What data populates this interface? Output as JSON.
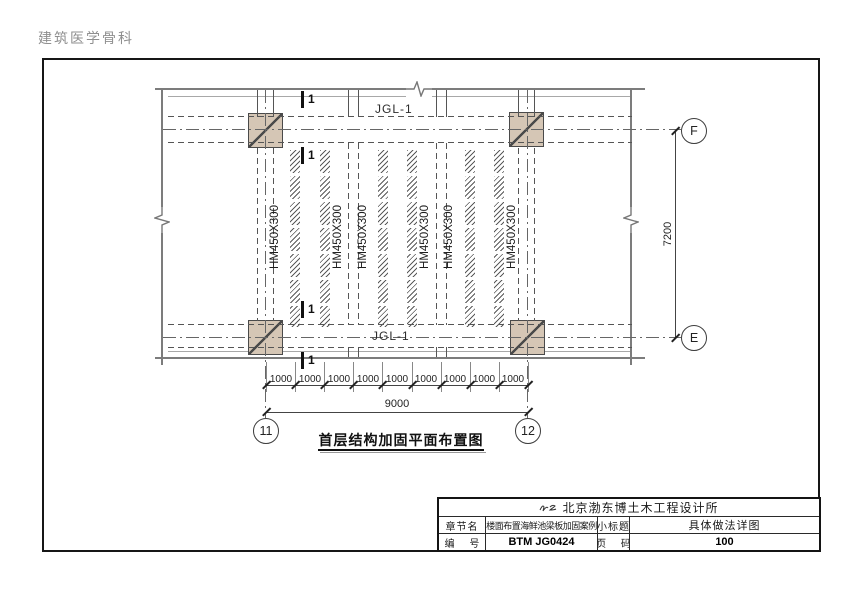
{
  "watermark": "建筑医学骨科",
  "plan": {
    "top_beam_label": "JGL-1",
    "bottom_beam_label": "JGL-1",
    "beam_labels": [
      "HM450X300",
      "HM450X300",
      "HM450X300",
      "HM450X300",
      "HM450X300",
      "HM450X300"
    ],
    "section_marks": [
      "1",
      "1",
      "1",
      "1"
    ],
    "grid_bubbles": {
      "right_top": "F",
      "right_bottom": "E",
      "bottom_left": "11",
      "bottom_right": "12"
    }
  },
  "dimensions": {
    "vertical_total": "7200",
    "segments": [
      "1000",
      "1000",
      "1000",
      "1000",
      "1000",
      "1000",
      "1000",
      "1000",
      "1000"
    ],
    "horizontal_total": "9000"
  },
  "drawing_title": "首层结构加固平面布置图",
  "title_block": {
    "company": "北京渤东博土木工程设计所",
    "chapter_label": "章节名",
    "chapter_value": "楼面布置海鲜池梁板加固案例",
    "subtitle_label": "小标题",
    "subtitle_value": "具体做法详图",
    "code_label": "编 号",
    "code_value": "BTM JG0424",
    "page_label": "页 码",
    "page_value": "100"
  },
  "colors": {
    "column_fill": "#d5c6b5",
    "line_gray": "#7c7c7c",
    "dash_gray": "#555555",
    "text_dark": "#111111"
  }
}
